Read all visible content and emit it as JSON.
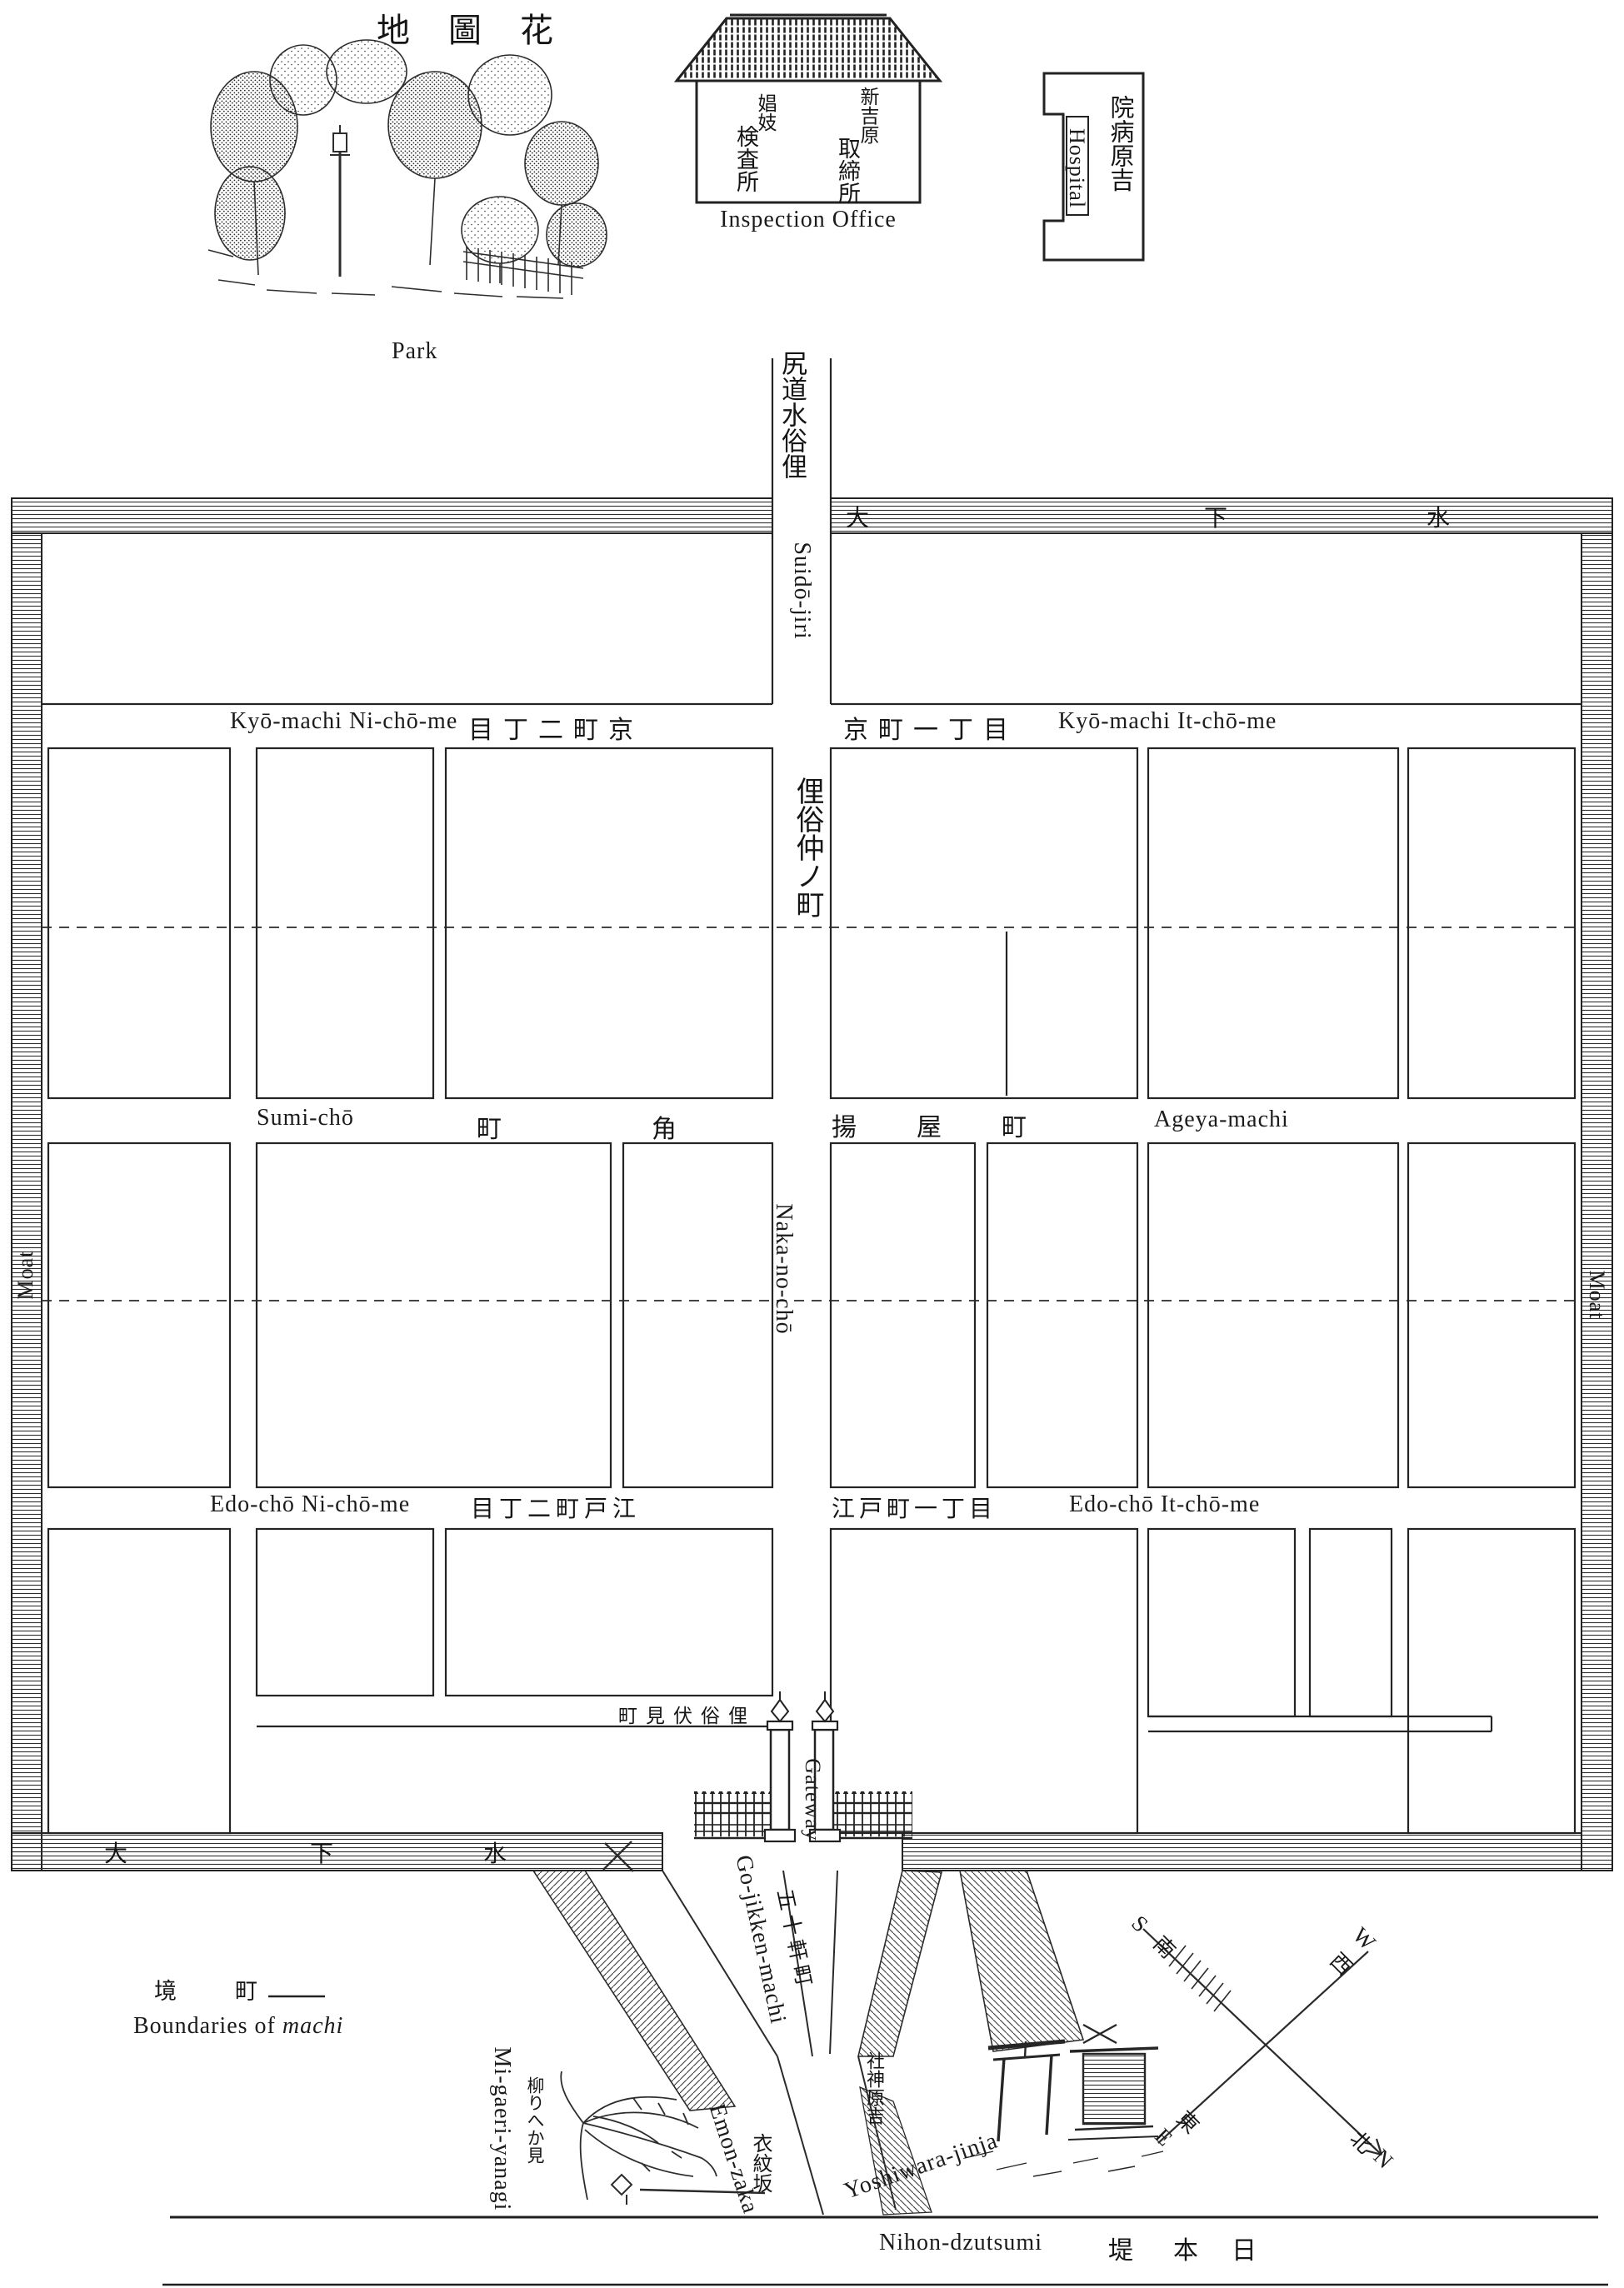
{
  "title": {
    "kanji": "地圖花"
  },
  "landmarks": {
    "park": {
      "label": "Park"
    },
    "inspection_office": {
      "label": "Inspection Office",
      "kanji_col1": "娼妓",
      "kanji_col2": "検査所",
      "kanji_col3": "新吉原",
      "kanji_col4": "取締所"
    },
    "hospital": {
      "label": "Hospital",
      "kanji": "院病原吉"
    },
    "migaeri_yanagi": {
      "label": "Mi-gaeri-yanagi",
      "kanji": "柳りへか見"
    },
    "yoshiwara_jinja": {
      "label": "Yoshiwara-jinja",
      "kanji": "社神原吉"
    }
  },
  "streets": {
    "suido_jiri": {
      "label": "Suidō-jiri",
      "kanji": "尻道水俗俚"
    },
    "kyo_machi_2": {
      "label": "Kyō-machi Ni-chō-me",
      "kanji": "目丁二町京"
    },
    "kyo_machi_1": {
      "label": "Kyō-machi It-chō-me",
      "kanji": "京町一丁目"
    },
    "naka_no_cho": {
      "label": "Naka-no-chō",
      "kanji": "俚俗仲ノ町"
    },
    "sumi_cho": {
      "label": "Sumi-chō",
      "kanji_1": "町",
      "kanji_2": "角"
    },
    "ageya_machi": {
      "label": "Ageya-machi",
      "kanji": "揚屋町"
    },
    "edo_cho_2": {
      "label": "Edo-chō Ni-chō-me",
      "kanji": "目丁二町戸江"
    },
    "edo_cho_1": {
      "label": "Edo-chō It-chō-me",
      "kanji": "江戸町一丁目"
    },
    "fushimi_cho": {
      "kanji": "町見伏俗俚"
    },
    "gateway": {
      "label": "Gateway"
    },
    "go_jikken_machi": {
      "label": "Go-jikken-machi",
      "kanji": "五十軒町"
    },
    "emon_zaka": {
      "label": "Emon-zaka",
      "kanji": "衣紋坂"
    },
    "nihon_dzutsumi": {
      "label": "Nihon-dzutsumi",
      "kanji": [
        "堤",
        "本",
        "日"
      ]
    }
  },
  "moat": {
    "label_left": "Moat",
    "label_right": "Moat",
    "top_chars": [
      "大",
      "下",
      "水"
    ],
    "bottom_chars": [
      "大",
      "下",
      "水"
    ]
  },
  "legend": {
    "kanji": [
      "境",
      "町"
    ],
    "text_prefix": "Boundaries of ",
    "text_italic": "machi"
  },
  "compass": {
    "north": {
      "letter": "N",
      "kanji": "北"
    },
    "south": {
      "letter": "S",
      "kanji": "南"
    },
    "east": {
      "letter": "E",
      "kanji": "東"
    },
    "west": {
      "letter": "W",
      "kanji": "西"
    }
  },
  "colors": {
    "ink": "#1b1b1b",
    "paper": "#ffffff"
  }
}
